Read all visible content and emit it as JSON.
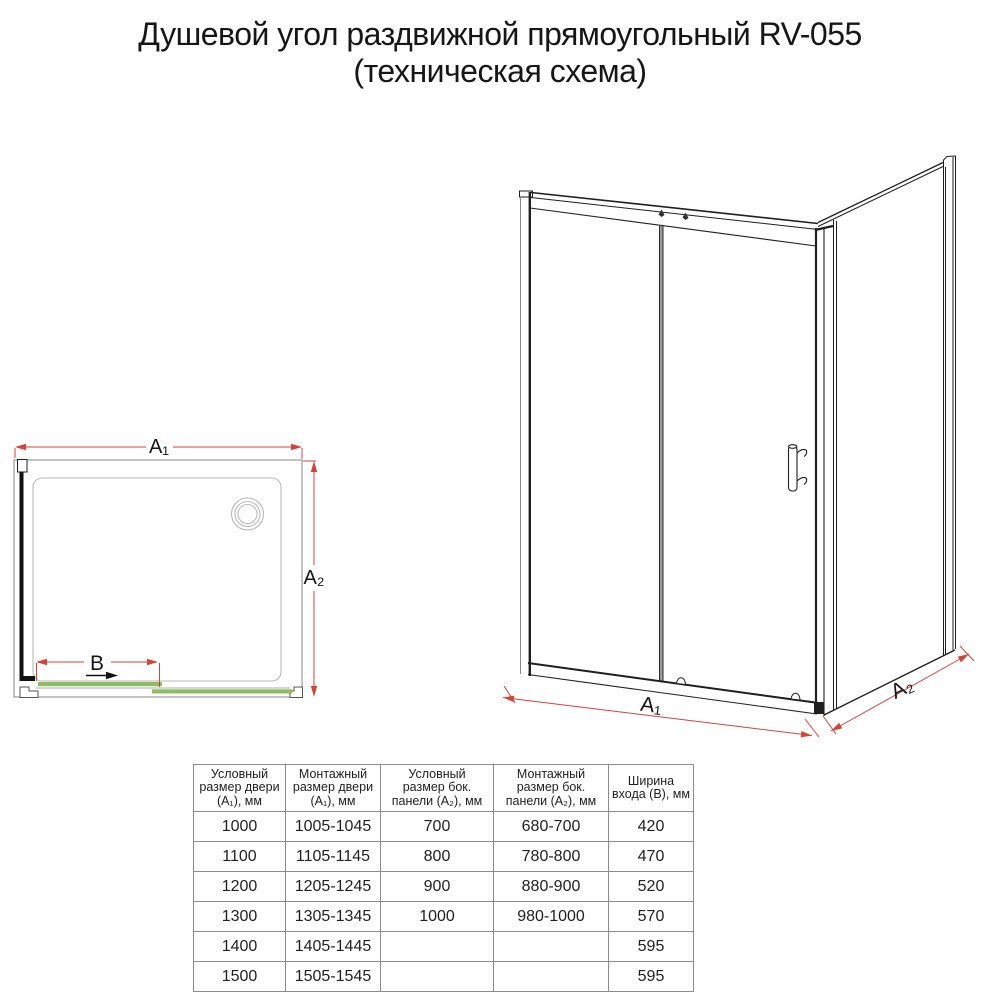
{
  "title": {
    "line1": "Душевой угол раздвижной прямоугольный RV-055",
    "line2": "(техническая схема)"
  },
  "plan_view": {
    "dim_a1": "A₁",
    "dim_a2": "A₂",
    "dim_b": "B"
  },
  "front_view": {
    "dim_a1": "A₁",
    "dim_a2": "A₂"
  },
  "colors": {
    "dimension_red": "#d6423a",
    "door_green": "#8cbe61",
    "line_black": "#1f1f1f",
    "line_gray": "#9b9b9b",
    "tray_gray": "#b9b9b9"
  },
  "table": {
    "headers": [
      "Условный\nразмер двери\n(А₁), мм",
      "Монтажный\nразмер двери\n(А₁), мм",
      "Условный\nразмер бок.\nпанели (А₂), мм",
      "Монтажный\nразмер бок.\nпанели (А₂), мм",
      "Ширина\nвхода (В), мм"
    ],
    "rows": [
      [
        "1000",
        "1005-1045",
        "700",
        "680-700",
        "420"
      ],
      [
        "1100",
        "1105-1145",
        "800",
        "780-800",
        "470"
      ],
      [
        "1200",
        "1205-1245",
        "900",
        "880-900",
        "520"
      ],
      [
        "1300",
        "1305-1345",
        "1000",
        "980-1000",
        "570"
      ],
      [
        "1400",
        "1405-1445",
        "",
        "",
        "595"
      ],
      [
        "1500",
        "1505-1545",
        "",
        "",
        "595"
      ]
    ]
  }
}
